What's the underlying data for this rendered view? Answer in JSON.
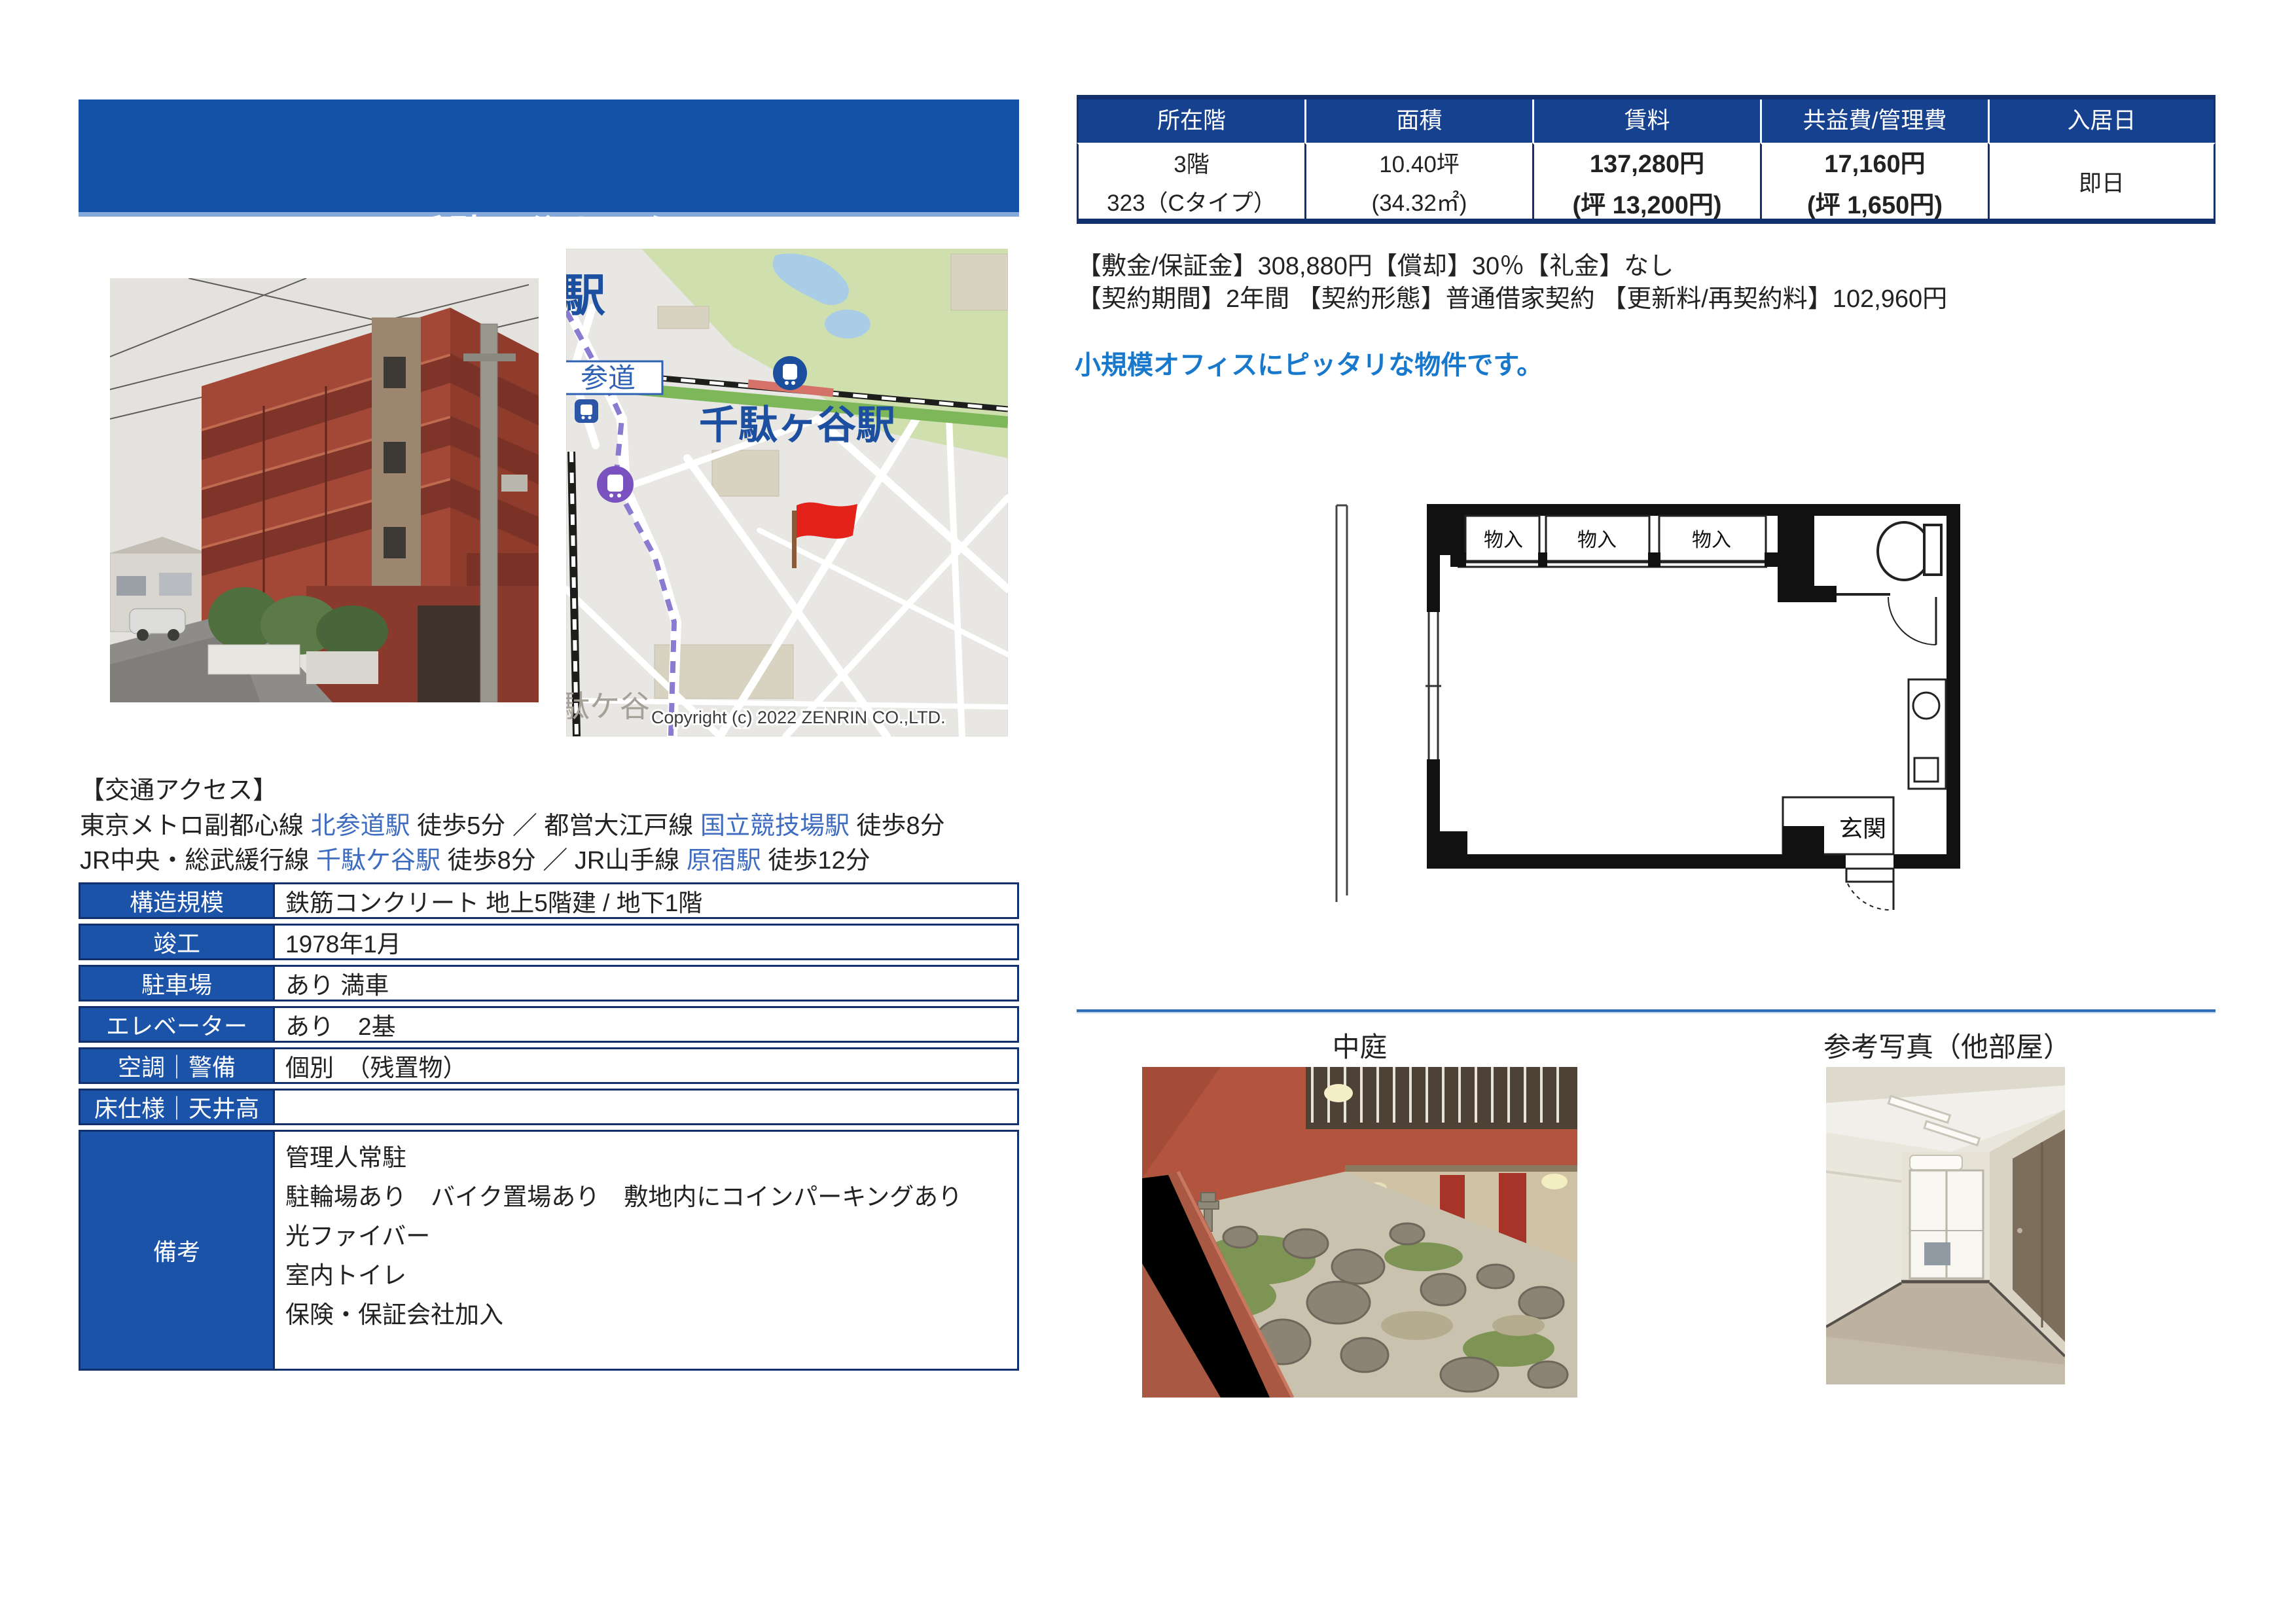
{
  "header": {
    "category": "事務所",
    "title": "千駄ヶ谷ホリタン",
    "address": "東京都渋谷区千駄ヶ谷2-39-3"
  },
  "summary": {
    "columns": [
      "所在階",
      "面積",
      "賃料",
      "共益費/管理費",
      "入居日"
    ],
    "floor_line1": "3階",
    "floor_line2": "323（Cタイプ）",
    "area_line1": "10.40坪",
    "area_line2": "(34.32㎡)",
    "rent_line1": "137,280円",
    "rent_line2": "(坪 13,200円)",
    "fee_line1": "17,160円",
    "fee_line2": "(坪 1,650円)",
    "move_in": "即日"
  },
  "terms": {
    "line1": "【敷金/保証金】308,880円【償却】30％【礼金】なし",
    "line2": "【契約期間】2年間 【契約形態】普通借家契約 【更新料/再契約料】102,960円",
    "highlight": "小規模オフィスにピッタリな物件です。"
  },
  "access": {
    "heading": "【交通アクセス】",
    "l1": [
      "東京メトロ副都心線 ",
      "北参道駅",
      " 徒歩5分 ／ 都営大江戸線 ",
      "国立競技場駅",
      " 徒歩8分"
    ],
    "l2": [
      "JR中央・総武緩行線 ",
      "千駄ケ谷駅",
      " 徒歩8分 ／ JR山手線 ",
      "原宿駅",
      " 徒歩12分"
    ]
  },
  "details": {
    "rows": [
      {
        "label": "構造規模",
        "value": "鉄筋コンクリート 地上5階建 / 地下1階"
      },
      {
        "label": "竣工",
        "value": "1978年1月"
      },
      {
        "label": "駐車場",
        "value": "あり 満車"
      },
      {
        "label": "エレベーター",
        "value": "あり　2基"
      },
      {
        "label": "空調｜警備",
        "value": "個別　（残置物）"
      },
      {
        "label": "床仕様｜天井高",
        "value": ""
      }
    ],
    "remarks": {
      "label": "備考",
      "lines": [
        "管理人常駐",
        "駐輪場あり　バイク置場あり　敷地内にコインパーキングあり",
        "光ファイバー",
        "室内トイレ",
        "保険・保証会社加入"
      ]
    }
  },
  "map": {
    "station_main": "千駄ヶ谷駅",
    "station_partial": "駅",
    "label_sando": "参道",
    "district_partial": "駄ケ谷",
    "copyright": "Copyright (c) 2022 ZENRIN CO.,LTD."
  },
  "floorplan": {
    "closets": [
      "物入",
      "物入",
      "物入"
    ],
    "entrance": "玄関"
  },
  "photos": {
    "courtyard_caption": "中庭",
    "reference_caption": "参考写真（他部屋）"
  },
  "colors": {
    "header_blue": "#1151a6",
    "table_head_navy": "#16418f",
    "border_navy": "#122f6e",
    "link_blue": "#3e6cc0",
    "promo_blue": "#1778cc",
    "map_station_blue": "#1d4fa0",
    "flag_red": "#e32219"
  }
}
